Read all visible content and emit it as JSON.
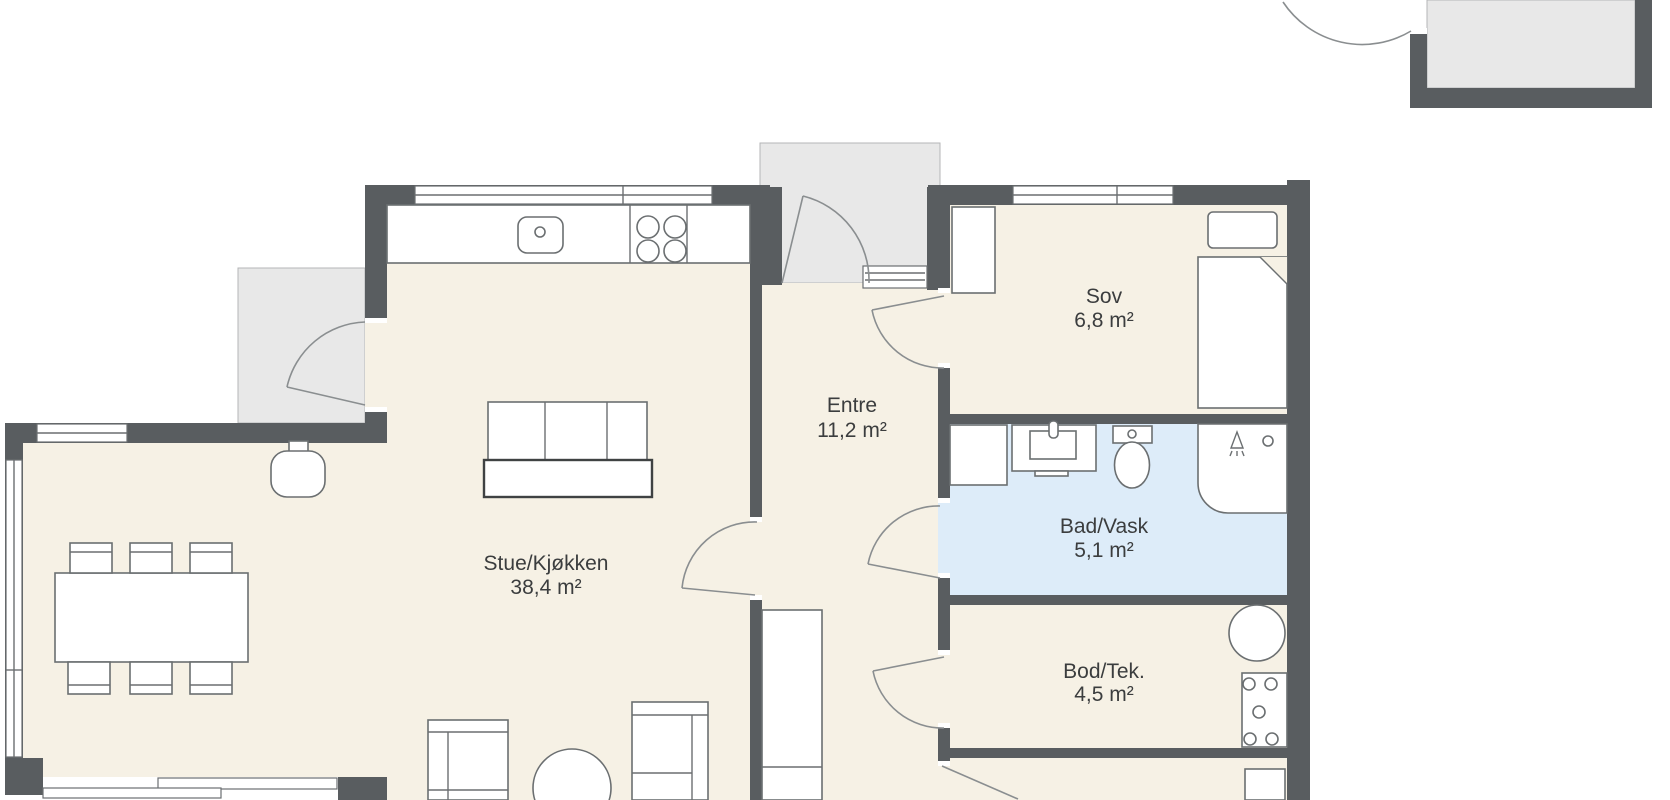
{
  "rooms": {
    "stue_kjokken": {
      "name": "Stue/Kjøkken",
      "area": "38,4 m²"
    },
    "entre": {
      "name": "Entre",
      "area": "11,2 m²"
    },
    "sov": {
      "name": "Sov",
      "area": "6,8 m²"
    },
    "bad_vask": {
      "name": "Bad/Vask",
      "area": "5,1 m²"
    },
    "bod_tek": {
      "name": "Bod/Tek.",
      "area": "4,5 m²"
    }
  },
  "colors": {
    "wall": "#595d60",
    "floor": "#f6f1e5",
    "bathroom_floor": "#ddecf9",
    "outdoor": "#e8e8e8",
    "furniture_outline": "#6b6f71",
    "door_arc": "#8a8e90",
    "label_text": "#3b3d3e",
    "background": "#ffffff"
  }
}
